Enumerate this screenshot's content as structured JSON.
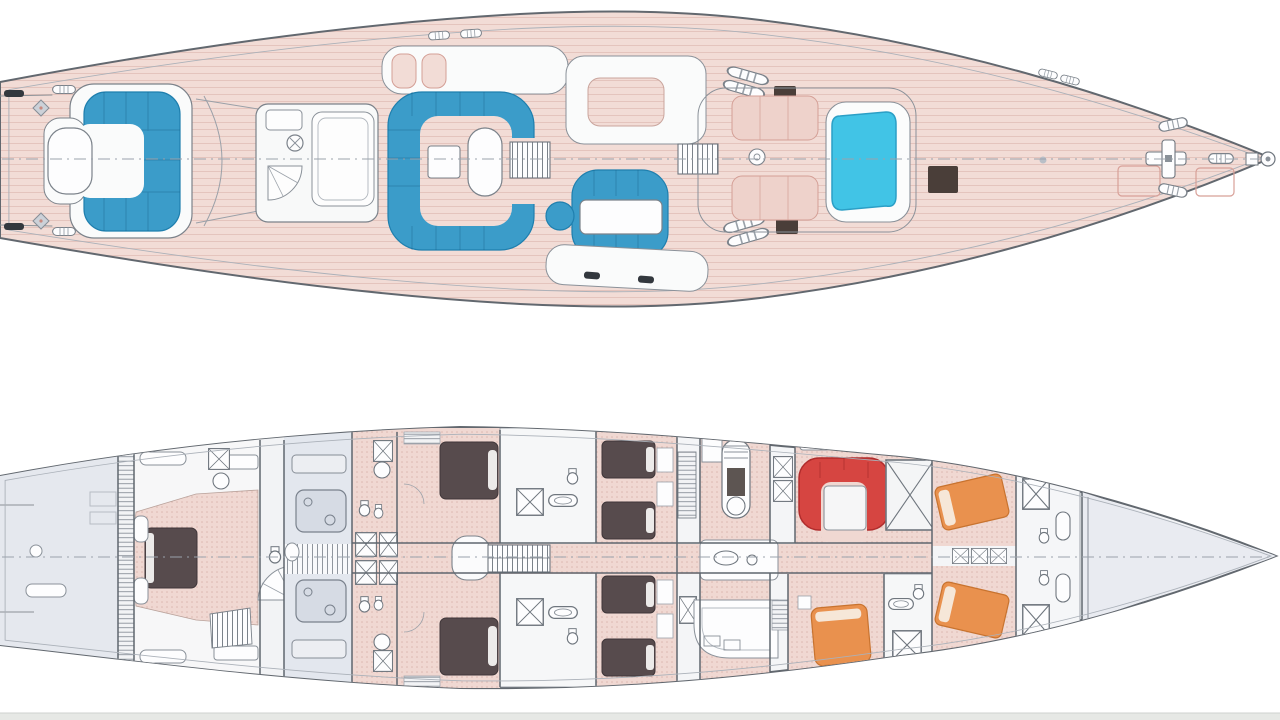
{
  "document": {
    "type": "yacht-general-arrangement-drawing",
    "views": [
      "main-deck-plan",
      "lower-deck-plan"
    ]
  },
  "colors": {
    "background": "#ffffff",
    "hull_stroke": "#62686f",
    "inner_stroke": "#abb1b9",
    "wall_stroke": "#5f666e",
    "fixture_stroke": "#6f767e",
    "deck_pink": "#f2dcd6",
    "floor_pink": "#f0d8d2",
    "pad_pink": "#eed2cb",
    "pad_stroke": "#d49f96",
    "structure_white": "#fafbfb",
    "seat_blue": "#3b9cc9",
    "seat_blue_dark": "#1f7fae",
    "pool_cyan": "#41c4e6",
    "pool_edge": "#2b9fc6",
    "hatch_dark": "#4a3e39",
    "cleat_dark": "#33383e",
    "bed_dark": "#574b4d",
    "bed_dark_edge": "#3f3639",
    "pillow_white": "#eceae9",
    "sofa_red": "#d64541",
    "sofa_red_dark": "#b02c2c",
    "bed_orange": "#e9914e",
    "bed_orange_dark": "#c8732f",
    "room_gray": "#e5e8ee",
    "corridor_gray": "#eef0f3",
    "machinery_gray": "#d6dbe4",
    "forepeak_gray": "#e9ebf1",
    "bath_white": "#f6f7f8",
    "footer_bar": "#e6e8e5",
    "footer_bar_line": "#cfd2cf"
  },
  "deck_plan": {
    "name": "main-deck-plan",
    "features": [
      "aft-cockpit-settee",
      "aft-cockpit-table",
      "windshield",
      "deckhouse",
      "skylight",
      "mast",
      "spiral-stair",
      "cockpit-u-settee",
      "cockpit-table",
      "companionway-stairs",
      "cockpit-dining-settee",
      "dining-table",
      "helm-winch-pedestals",
      "deck-hatches",
      "sun-pads",
      "vent",
      "spa-pool",
      "foredeck-hatches",
      "anchor-windlass",
      "bow-fitting",
      "mooring-cleats",
      "centerline"
    ]
  },
  "lower_deck_plan": {
    "name": "lower-deck-plan",
    "features": [
      "lazarette",
      "owner-cabin",
      "owner-bed",
      "owner-bathroom",
      "lobby-spiral-stair",
      "engine-room",
      "guest-bathrooms",
      "guest-cabin-double-port",
      "guest-cabin-double-starboard",
      "guest-cabin-twin-port",
      "guest-cabin-twin-starboard",
      "central-staircase",
      "galley",
      "crew-companionway",
      "crew-mess",
      "crew-mess-sofa",
      "crew-mess-table",
      "engine-casing",
      "crew-cabin-aft",
      "crew-cabins-forward",
      "crew-beds",
      "forward-bathrooms",
      "forepeak",
      "centerline"
    ]
  },
  "footer": {
    "label": ""
  }
}
